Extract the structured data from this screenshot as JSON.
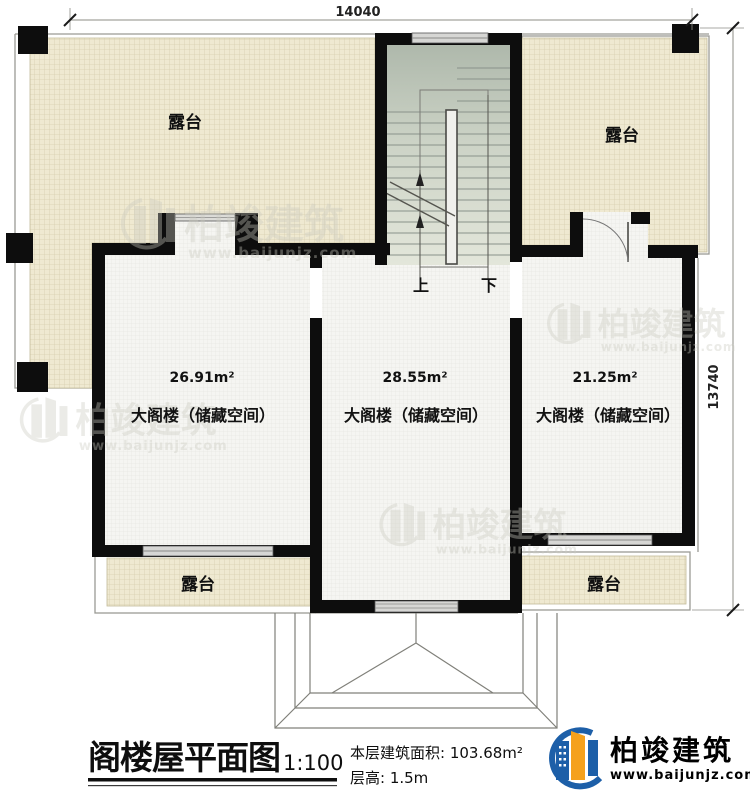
{
  "dimensions": {
    "top": "14040",
    "right": "13740"
  },
  "terraces": {
    "top_left": "露台",
    "top_right": "露台",
    "bottom_left": "露台",
    "bottom_right": "露台"
  },
  "rooms": {
    "left": {
      "area": "26.91m²",
      "name": "大阁楼（储藏空间）"
    },
    "middle": {
      "area": "28.55m²",
      "name": "大阁楼（储藏空间）"
    },
    "right": {
      "area": "21.25m²",
      "name": "大阁楼（储藏空间）"
    }
  },
  "stairs": {
    "up_label": "上",
    "down_label": "下"
  },
  "title_block": {
    "title": "阁楼屋平面图",
    "scale": "1:100",
    "floor_area": "本层建筑面积: 103.68m²",
    "floor_height": "层高: 1.5m"
  },
  "brand": {
    "name": "柏竣建筑",
    "website": "www.baijunjz.com"
  },
  "watermark": {
    "name": "柏竣建筑",
    "website": "www.baijunjz.com"
  },
  "colors": {
    "wall": "#0d0d0d",
    "terrace_fill": "#efe9d1",
    "stair_fill": "#c3ccbd",
    "brand_blue": "#1d5fa8",
    "brand_orange": "#f5a11c"
  }
}
